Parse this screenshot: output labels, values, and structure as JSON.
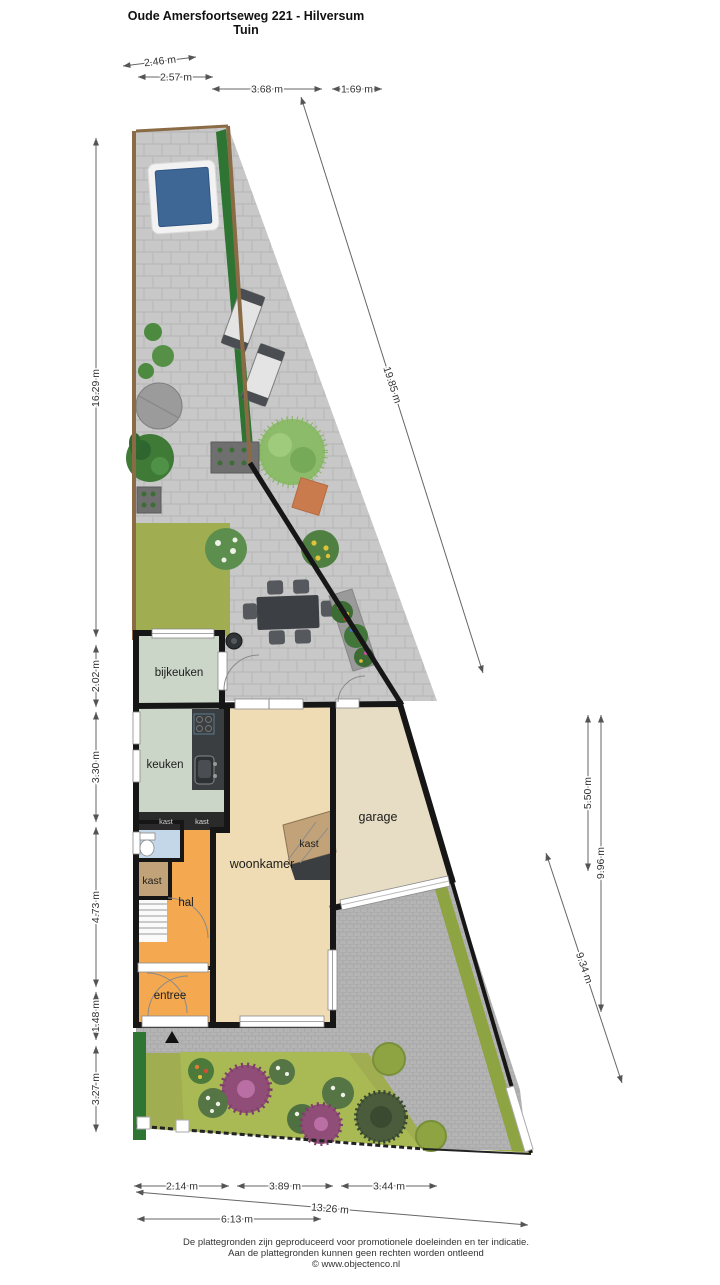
{
  "header": {
    "title": "Oude Amersfoortseweg 221 - Hilversum",
    "subtitle": "Tuin"
  },
  "rooms": {
    "bijkeuken": "bijkeuken",
    "keuken": "keuken",
    "kast_mini_a": "kast",
    "kast_mini_b": "kast",
    "kast_left": "kast",
    "hal": "hal",
    "woonkamer": "woonkamer",
    "kast_woonkamer": "kast",
    "entree": "entree",
    "garage": "garage"
  },
  "dimensions": {
    "top": [
      "2.46 m",
      "2.57 m",
      "3.68 m",
      "1.69 m"
    ],
    "left": [
      "16.29 m",
      "2.02 m",
      "3.30 m",
      "4.73 m",
      "1.48 m",
      "3.27 m"
    ],
    "right": [
      "5.50 m",
      "9.96 m",
      "9.34 m"
    ],
    "diagonal": "19.85 m",
    "bottom": [
      "2.14 m",
      "3.89 m",
      "3.44 m"
    ],
    "bottom_total": "13.26 m",
    "bottom_inner": "6.13 m"
  },
  "footer": {
    "line1": "De plattegronden zijn geproduceerd voor promotionele doeleinden en ter indicatie.",
    "line2": "Aan de plattegronden kunnen geen rechten worden ontleend",
    "line3": "© www.objectenco.nl"
  },
  "colors": {
    "wall": "#161616",
    "terrace": "#c8c8c8",
    "driveway": "#b4b4b4",
    "grass": "#a0ad50",
    "bed_green": "#a9ba55",
    "hedge": "#2e7433",
    "fence": "#8b6b45",
    "pool_water": "#3e6795",
    "pool_deck": "#f2f2f2",
    "floor_sage": "#ccd6c8",
    "floor_beige": "#f0dcb4",
    "floor_cream": "#e7ddc4",
    "floor_orange": "#f4a950",
    "floor_tan": "#c2a379",
    "floor_blue": "#c3d7e8",
    "counter": "#3a3e41",
    "table": "#3c4045"
  }
}
